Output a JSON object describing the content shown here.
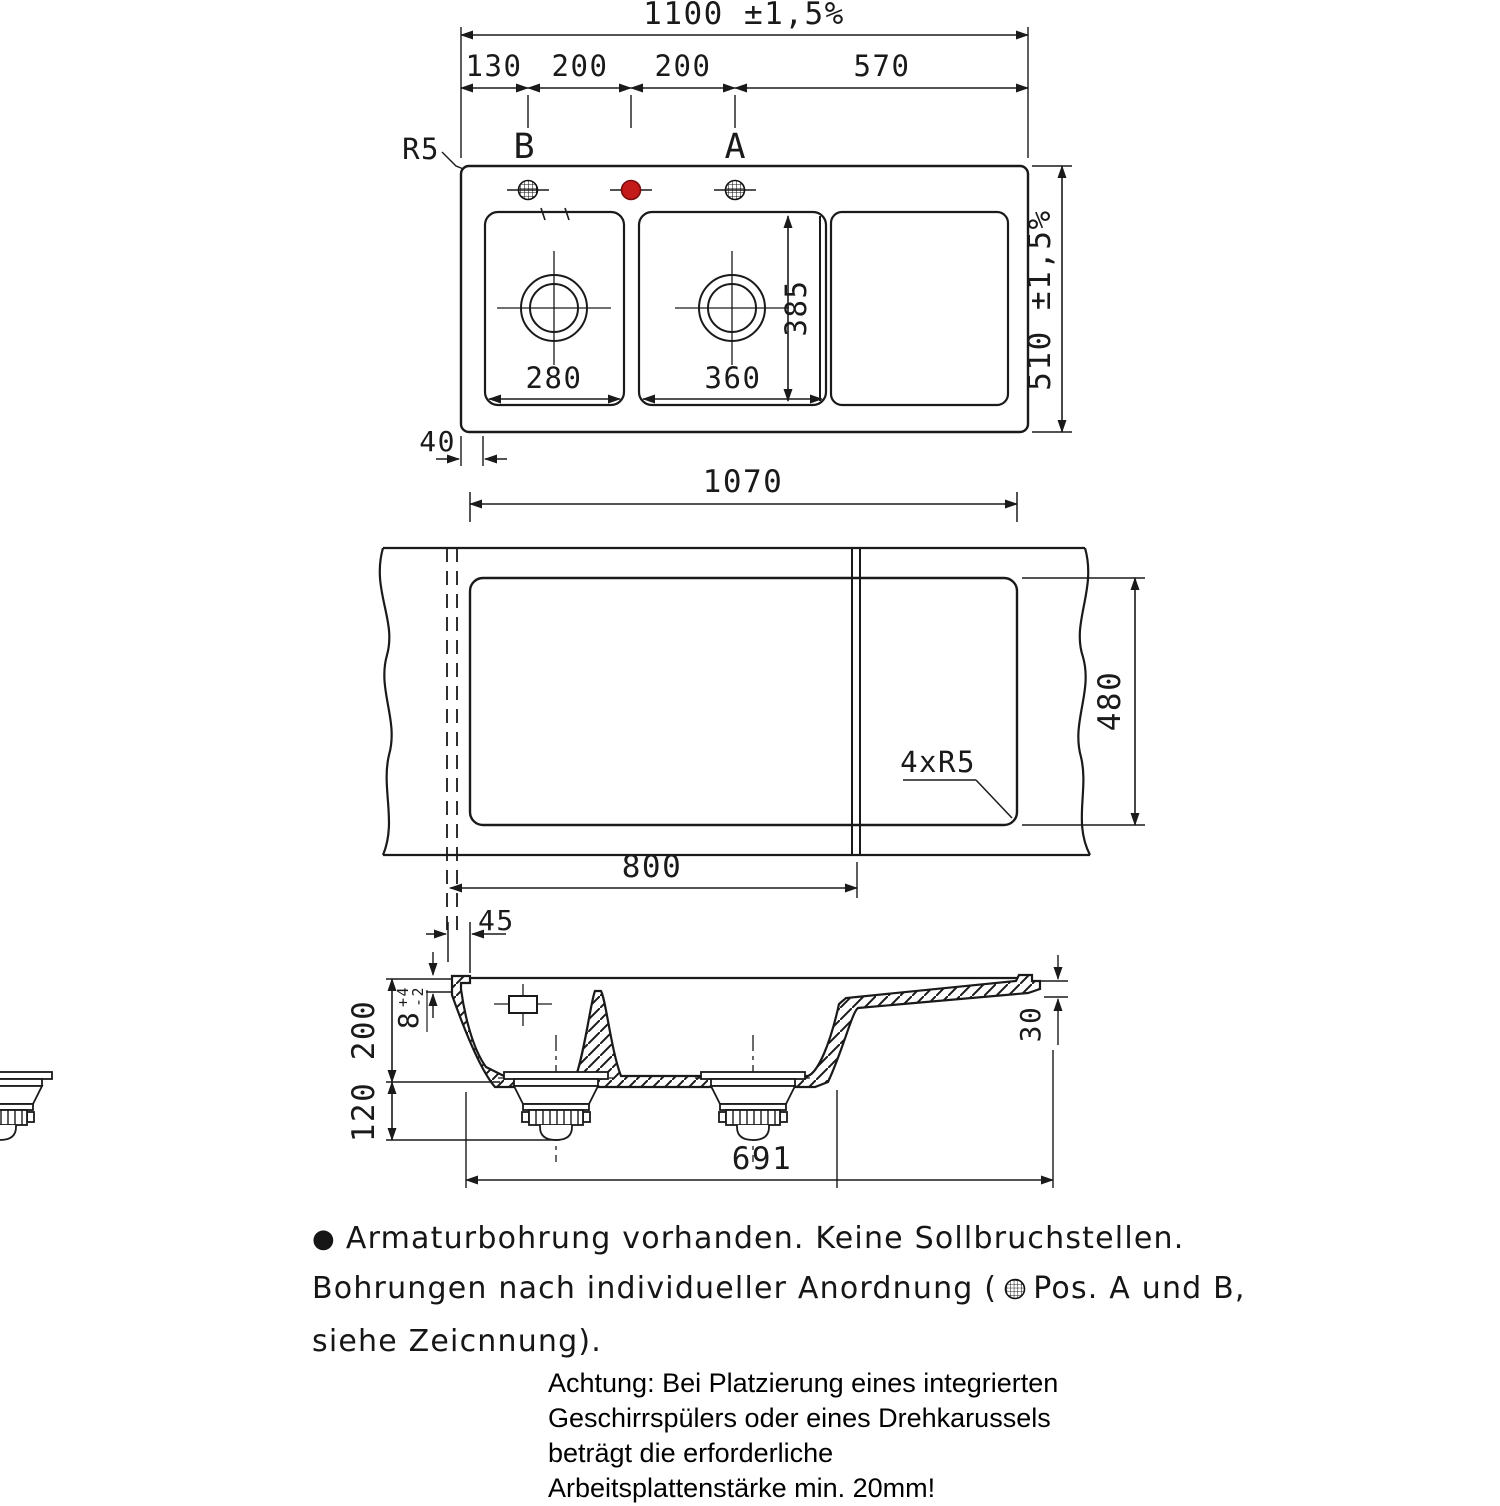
{
  "colors": {
    "ink": "#1a1a1a",
    "red": "#c41a1a"
  },
  "top_view": {
    "dim_total": "1100 ±1,5%",
    "seg_130": "130",
    "seg_200a": "200",
    "seg_200b": "200",
    "seg_570": "570",
    "corner_radius": "R5",
    "pos_b": "B",
    "pos_a": "A",
    "dim_depth": "510 ±1,5%",
    "dim_bowl2_inner": "385",
    "dim_bowl1_width": "280",
    "dim_bowl2_width": "360",
    "dim_edge": "40"
  },
  "cutout_view": {
    "dim_width": "1070",
    "dim_height": "480",
    "corner_note": "4xR5",
    "dim_cut": "800",
    "dim_offset": "45"
  },
  "section_view": {
    "dim_depth": "200",
    "dim_drain": "120",
    "dim_rim": "8",
    "tol_plus": "+4",
    "tol_minus": "-2",
    "dim_board": "30",
    "dim_span": "691"
  },
  "notes": {
    "bullet": "●",
    "line1": "Armaturbohrung vorhanden. Keine Sollbruchstellen.",
    "line2_pre": "Bohrungen nach individueller Anordnung (",
    "line2_post": "Pos. A und B,",
    "line3": "siehe Zeicnnung)."
  },
  "warning": {
    "line1": "Achtung: Bei Platzierung eines integrierten",
    "line2": "Geschirrspülers oder eines Drehkarussels",
    "line3": "beträgt die erforderliche",
    "line4": "Arbeitsplattenstärke min. 20mm!"
  }
}
